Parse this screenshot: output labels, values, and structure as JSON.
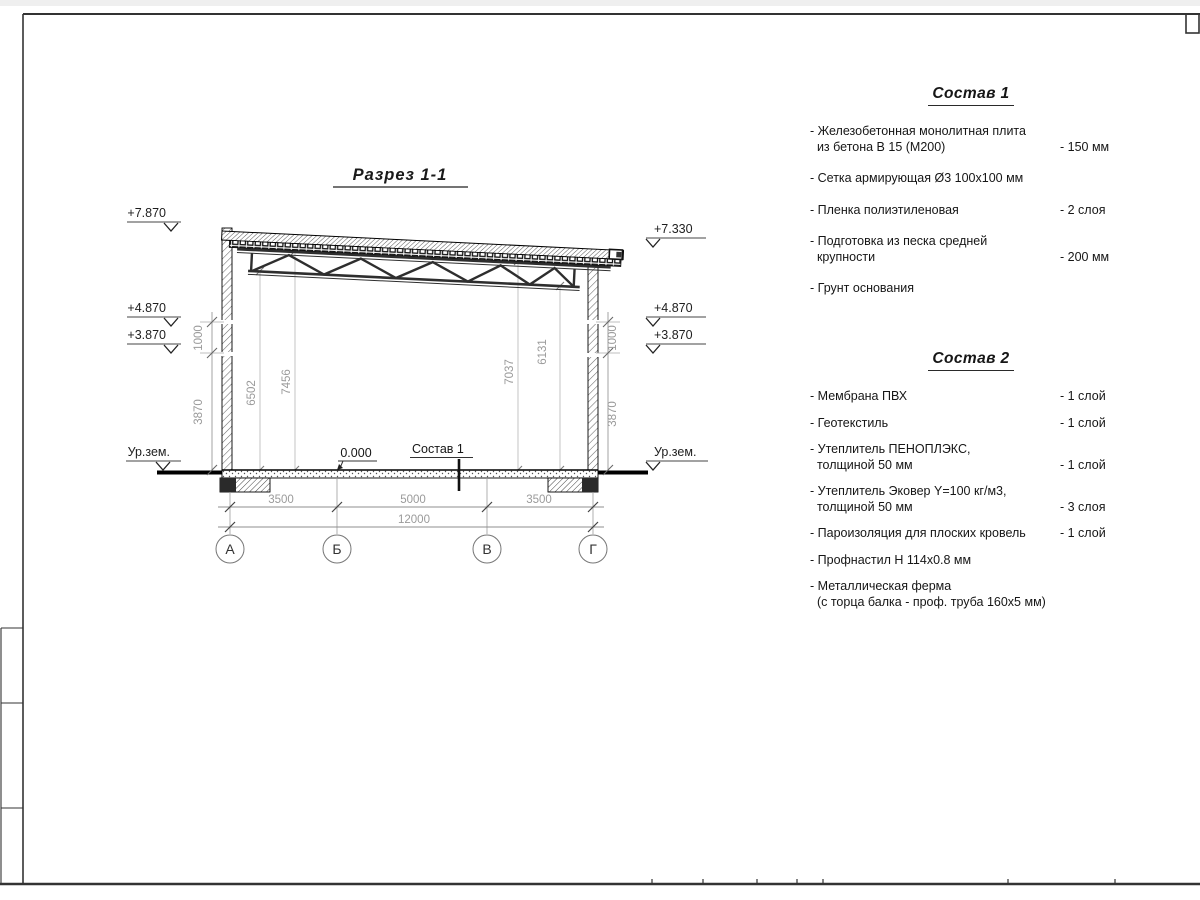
{
  "sheet": {
    "type_label": "Чертеж разреза здания"
  },
  "drawing": {
    "title": "Разрез 1-1",
    "marks_left": [
      "+7.870",
      "+4.870",
      "+3.870"
    ],
    "ground_left": "Ур.зем.",
    "marks_right": [
      "+7.330",
      "+4.870",
      "+3.870"
    ],
    "ground_right": "Ур.зем.",
    "zero_mark": "0.000",
    "floor_leader": "Состав 1",
    "dims_bottom": [
      "3500",
      "5000",
      "3500"
    ],
    "dim_total": "12000",
    "dims_left": [
      "1000",
      "3870"
    ],
    "dims_right": [
      "1000",
      "3870"
    ],
    "dims_interior": [
      "6502",
      "7456",
      "7037",
      "6131"
    ],
    "axes": [
      "А",
      "Б",
      "В",
      "Г"
    ]
  },
  "sostav1": {
    "title": "Состав 1",
    "items": [
      {
        "text": "- Железобетонная  монолитная плита\n  из бетона В 15 (М200)",
        "value": "- 150 мм"
      },
      {
        "text": "- Сетка армирующая Ø3 100х100 мм",
        "value": ""
      },
      {
        "text": "- Пленка полиэтиленовая",
        "value": "-  2 слоя"
      },
      {
        "text": "- Подготовка из песка средней\n  крупности",
        "value": "- 200 мм"
      },
      {
        "text": "- Грунт основания",
        "value": ""
      }
    ]
  },
  "sostav2": {
    "title": "Состав 2",
    "items": [
      {
        "text": "- Мембрана ПВХ",
        "value": "- 1 слой"
      },
      {
        "text": "- Геотекстиль",
        "value": "- 1 слой"
      },
      {
        "text": "- Утеплитель ПЕНОПЛЭКС,\n  толщиной 50 мм",
        "value": "- 1 слой"
      },
      {
        "text": "- Утеплитель Эковер Y=100 кг/м3,\n  толщиной 50 мм",
        "value": "- 3 слоя"
      },
      {
        "text": "- Пароизоляция для плоских кровель",
        "value": "- 1 слой"
      },
      {
        "text": "- Профнастил Н 114х0.8 мм",
        "value": ""
      },
      {
        "text": "- Металлическая ферма\n  (с торца балка - проф. труба 160х5 мм)",
        "value": ""
      }
    ]
  },
  "colors": {
    "line": "#1a1a1a",
    "dim_text": "#9a9a9a",
    "frame": "#333333"
  }
}
